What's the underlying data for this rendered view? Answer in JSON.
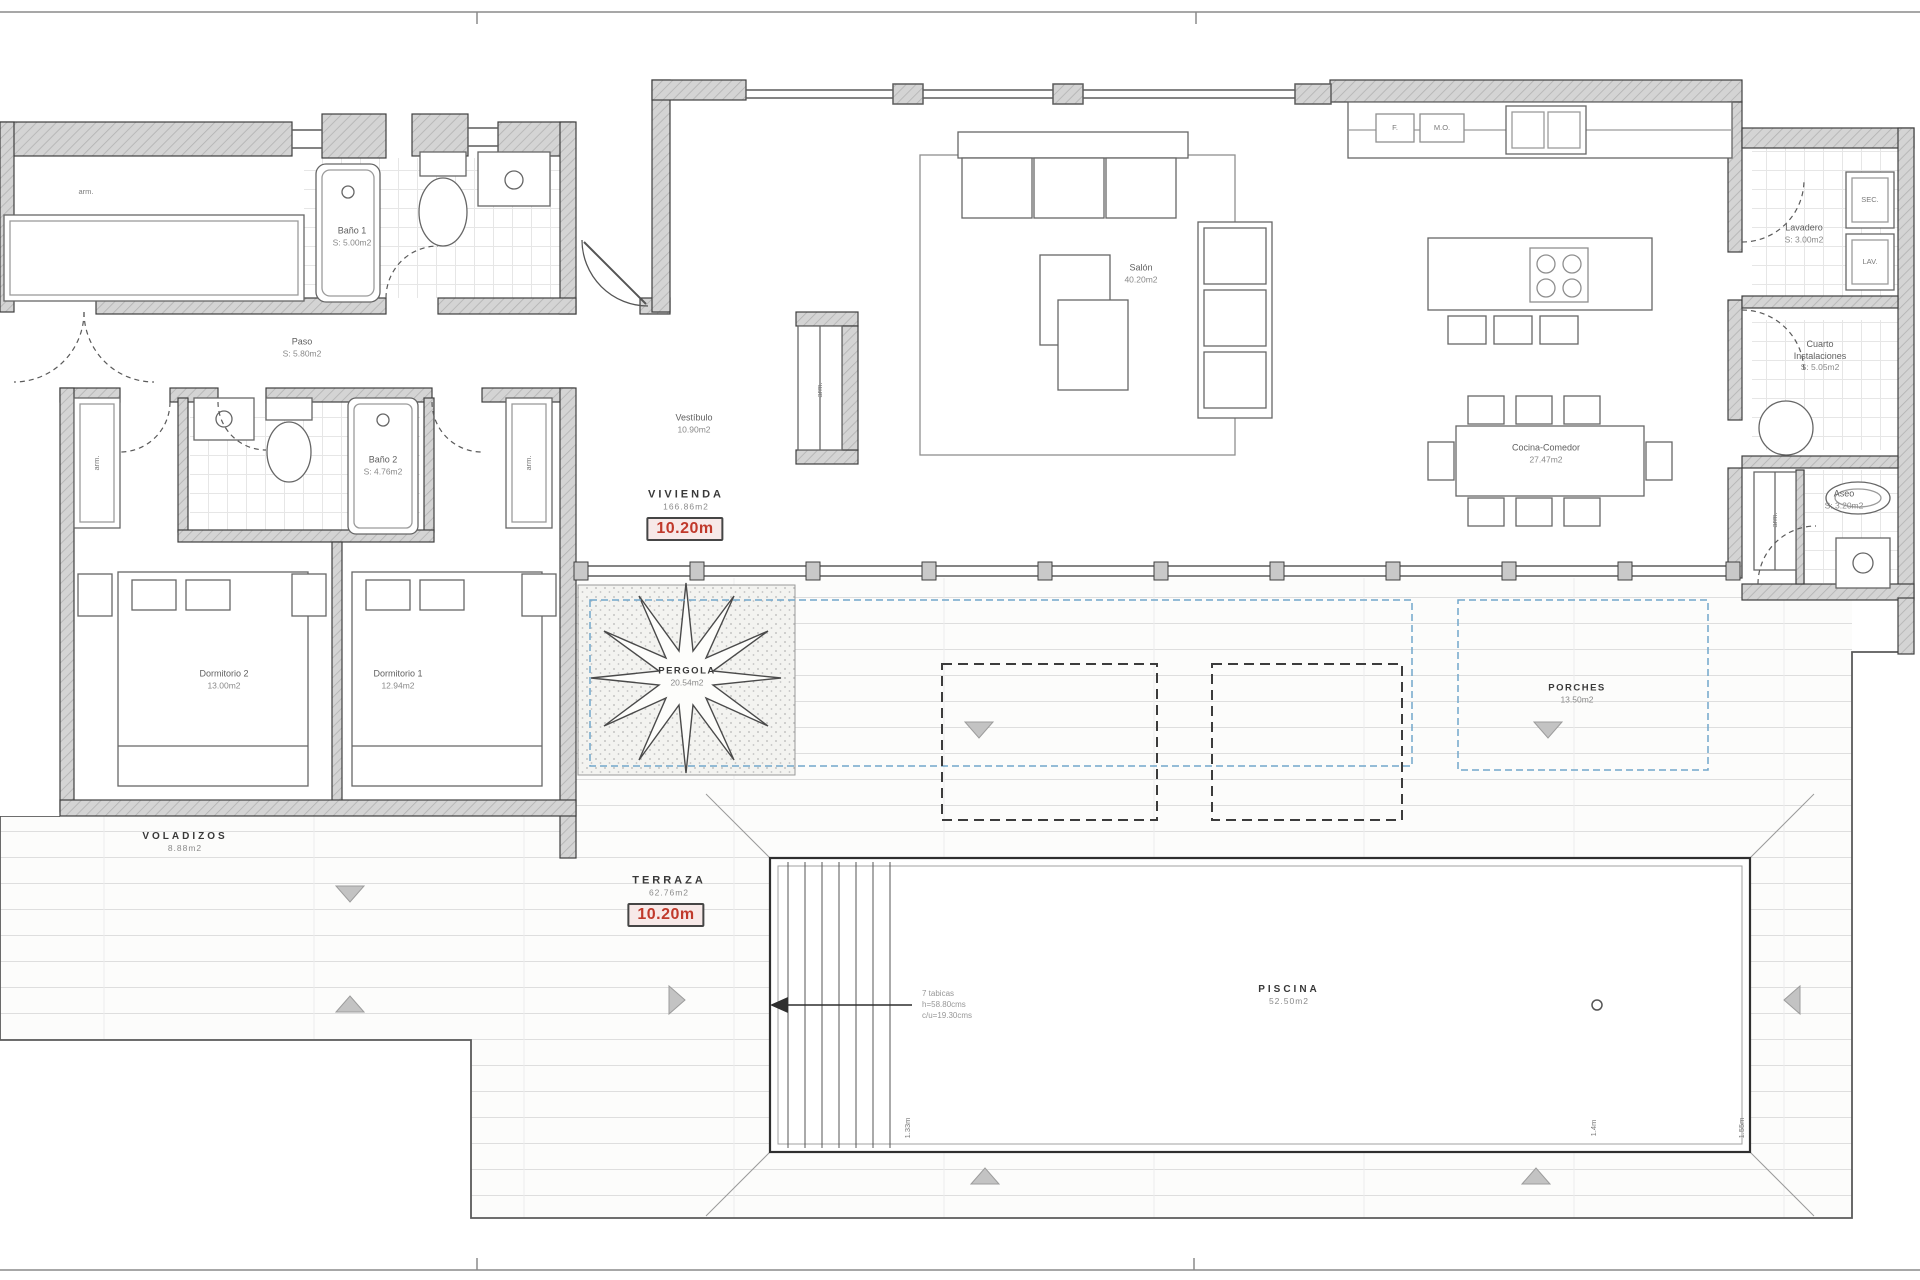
{
  "rooms": {
    "bano1": {
      "name": "Baño 1",
      "area": "S: 5.00m2"
    },
    "paso": {
      "name": "Paso",
      "area": "S: 5.80m2"
    },
    "bano2": {
      "name": "Baño 2",
      "area": "S: 4.76m2"
    },
    "dormitorio2": {
      "name": "Dormitorio 2",
      "area": "13.00m2"
    },
    "dormitorio1": {
      "name": "Dormitorio 1",
      "area": "12.94m2"
    },
    "vestibulo": {
      "name": "Vestíbulo",
      "area": "10.90m2"
    },
    "salon": {
      "name": "Salón",
      "area": "40.20m2"
    },
    "cocina_comedor": {
      "name": "Cocina-Comedor",
      "area": "27.47m2"
    },
    "lavadero": {
      "name": "Lavadero",
      "area": "S: 3.00m2"
    },
    "cuarto_instalaciones": {
      "line1": "Cuarto",
      "line2": "Instalaciones",
      "area": "S: 5.05m2"
    },
    "aseo": {
      "name": "Aseo",
      "area": "S: 3.20m2"
    },
    "vivienda": {
      "name": "VIVIENDA",
      "area": "166.86m2"
    },
    "pergola": {
      "name": "PERGOLA",
      "area": "20.54m2"
    },
    "porches": {
      "name": "PORCHES",
      "area": "13.50m2"
    },
    "voladizos": {
      "name": "VOLADIZOS",
      "area": "8.88m2"
    },
    "terraza": {
      "name": "TERRAZA",
      "area": "62.76m2"
    },
    "piscina": {
      "name": "PISCINA",
      "area": "52.50m2"
    }
  },
  "dimensions": {
    "vivienda_width": "10.20m",
    "terraza_width": "10.20m"
  },
  "appliances": {
    "sec": "SEC.",
    "lav": "LAV.",
    "fridge": "F.",
    "micro_oven": "M.O."
  },
  "closet_label": "arm.",
  "pool": {
    "stairs_note": [
      "7 tabicas",
      "h=58.80cms",
      "c/u=19.30cms"
    ],
    "depths": [
      "1.33m",
      "1.4m",
      "1.55m"
    ]
  },
  "colors": {
    "dimension_red": "#c0392b",
    "dashed_blue": "#72a7cb",
    "wall_gray": "#d4d4d4"
  }
}
